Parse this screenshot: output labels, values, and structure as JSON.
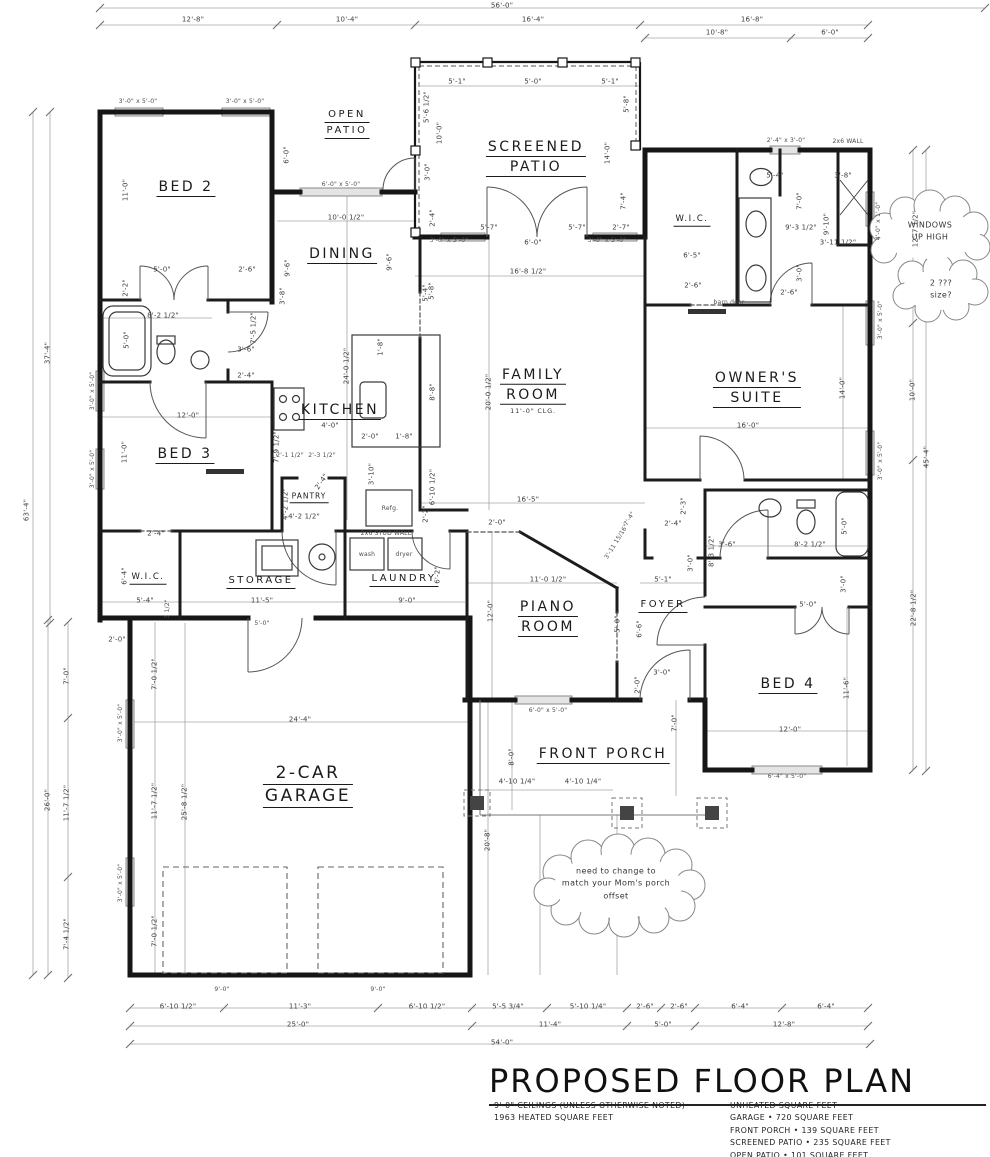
{
  "title_block": {
    "title": "PROPOSED FLOOR PLAN",
    "notes_left": [
      "9'-0\" CEILINGS (UNLESS OTHERWISE NOTED)",
      "1963 HEATED SQUARE FEET"
    ],
    "notes_right": [
      "UNHEATED SQUARE FEET",
      "GARAGE • 720 SQUARE FEET",
      "FRONT PORCH • 139 SQUARE FEET",
      "SCREENED PATIO • 235 SQUARE FEET",
      "OPEN PATIO • 101 SQUARE FEET"
    ]
  },
  "colors": {
    "wall": "#161616",
    "dim_text": "#3c3c3c",
    "dim_line": "#a6a6a6",
    "paper": "#ffffff"
  },
  "rooms": [
    {
      "id": "bed-2",
      "lines": [
        "BED 2"
      ],
      "x": 186,
      "y": 190,
      "size": "lg"
    },
    {
      "id": "open-patio",
      "lines": [
        "OPEN",
        "PATIO"
      ],
      "x": 347,
      "y": 126,
      "size": "md"
    },
    {
      "id": "screened-patio",
      "lines": [
        "SCREENED",
        "PATIO"
      ],
      "x": 536,
      "y": 160,
      "size": "lg"
    },
    {
      "id": "dining",
      "lines": [
        "DINING"
      ],
      "x": 342,
      "y": 257,
      "size": "lg"
    },
    {
      "id": "wic-owners",
      "lines": [
        "W.I.C."
      ],
      "x": 692,
      "y": 222,
      "size": "sm"
    },
    {
      "id": "owners-suite",
      "lines": [
        "OWNER'S",
        "SUITE"
      ],
      "x": 757,
      "y": 391,
      "size": "lg"
    },
    {
      "id": "kitchen",
      "lines": [
        "KITCHEN"
      ],
      "x": 340,
      "y": 413,
      "size": "lg"
    },
    {
      "id": "family-room",
      "lines": [
        "FAMILY",
        "ROOM"
      ],
      "x": 533,
      "y": 391,
      "size": "lg",
      "sub": "11'-0\" CLG."
    },
    {
      "id": "bed-3",
      "lines": [
        "BED 3"
      ],
      "x": 185,
      "y": 457,
      "size": "lg"
    },
    {
      "id": "pantry",
      "lines": [
        "PANTRY"
      ],
      "x": 309,
      "y": 499,
      "size": "xs"
    },
    {
      "id": "wic-left",
      "lines": [
        "W.I.C."
      ],
      "x": 148,
      "y": 580,
      "size": "sm"
    },
    {
      "id": "storage",
      "lines": [
        "STORAGE"
      ],
      "x": 261,
      "y": 584,
      "size": "md"
    },
    {
      "id": "laundry",
      "lines": [
        "LAUNDRY"
      ],
      "x": 404,
      "y": 582,
      "size": "md"
    },
    {
      "id": "piano-room",
      "lines": [
        "PIANO",
        "ROOM"
      ],
      "x": 548,
      "y": 620,
      "size": "lg"
    },
    {
      "id": "foyer",
      "lines": [
        "FOYER"
      ],
      "x": 663,
      "y": 608,
      "size": "md"
    },
    {
      "id": "bed-4",
      "lines": [
        "BED 4"
      ],
      "x": 788,
      "y": 687,
      "size": "lg"
    },
    {
      "id": "garage",
      "lines": [
        "2-CAR",
        "GARAGE"
      ],
      "x": 308,
      "y": 788,
      "size": "xl"
    },
    {
      "id": "front-porch",
      "lines": [
        "FRONT PORCH"
      ],
      "x": 603,
      "y": 757,
      "size": "lg"
    }
  ],
  "clouds": [
    {
      "id": "windows-up-high",
      "lines": [
        "WINDOWS",
        "UP HIGH"
      ],
      "x": 930,
      "y": 232
    },
    {
      "id": "window-size-question",
      "lines": [
        "2 ???",
        "size?"
      ],
      "x": 941,
      "y": 290
    },
    {
      "id": "porch-offset-note",
      "lines": [
        "need to change to",
        "match your Mom's porch",
        "offset"
      ],
      "x": 616,
      "y": 884
    }
  ],
  "dims": [
    {
      "t": "56'-0\"",
      "x": 502,
      "y": 6
    },
    {
      "t": "12'-8\"",
      "x": 193,
      "y": 20
    },
    {
      "t": "10'-4\"",
      "x": 347,
      "y": 20
    },
    {
      "t": "16'-4\"",
      "x": 533,
      "y": 20
    },
    {
      "t": "16'-8\"",
      "x": 752,
      "y": 20
    },
    {
      "t": "10'-8\"",
      "x": 717,
      "y": 33
    },
    {
      "t": "6'-0\"",
      "x": 830,
      "y": 33
    },
    {
      "t": "3'-0\" x 5'-0\"",
      "x": 138,
      "y": 102,
      "s": 1
    },
    {
      "t": "3'-0\" x 5'-0\"",
      "x": 245,
      "y": 102,
      "s": 1
    },
    {
      "t": "2'-4\" x 3'-0\"",
      "x": 786,
      "y": 141,
      "s": 1
    },
    {
      "t": "2x6 WALL",
      "x": 848,
      "y": 142,
      "s": 1
    },
    {
      "t": "5'-1\"",
      "x": 457,
      "y": 82
    },
    {
      "t": "5'-0\"",
      "x": 533,
      "y": 82
    },
    {
      "t": "5'-1\"",
      "x": 610,
      "y": 82
    },
    {
      "t": "5'-6 1/2\"",
      "x": 427,
      "y": 107,
      "r": -90
    },
    {
      "t": "10'-0\"",
      "x": 440,
      "y": 133,
      "r": -90
    },
    {
      "t": "3'-0\"",
      "x": 428,
      "y": 172,
      "r": -90
    },
    {
      "t": "2'-4\"",
      "x": 433,
      "y": 218,
      "r": -90
    },
    {
      "t": "5'-8\"",
      "x": 627,
      "y": 104,
      "r": -90
    },
    {
      "t": "14'-0\"",
      "x": 608,
      "y": 153,
      "r": -90
    },
    {
      "t": "7'-4\"",
      "x": 624,
      "y": 201,
      "r": -90
    },
    {
      "t": "2'-7\"",
      "x": 621,
      "y": 228
    },
    {
      "t": "5'-7\"",
      "x": 489,
      "y": 228
    },
    {
      "t": "6'-0\"",
      "x": 533,
      "y": 243
    },
    {
      "t": "5'-7\"",
      "x": 577,
      "y": 228
    },
    {
      "t": "3'-0\" x 5'-0\"",
      "x": 449,
      "y": 241,
      "s": 1
    },
    {
      "t": "3'-0\" x 5'-0\"",
      "x": 607,
      "y": 241,
      "s": 1
    },
    {
      "t": "16'-8 1/2\"",
      "x": 528,
      "y": 272
    },
    {
      "t": "5'-8\"",
      "x": 432,
      "y": 291,
      "r": -90
    },
    {
      "t": "6'-0\" x 5'-0\"",
      "x": 341,
      "y": 185,
      "s": 1
    },
    {
      "t": "10'-0 1/2\"",
      "x": 346,
      "y": 218
    },
    {
      "t": "6'-0\"",
      "x": 287,
      "y": 155,
      "r": -90
    },
    {
      "t": "9'-6\"",
      "x": 288,
      "y": 268,
      "r": -90
    },
    {
      "t": "9'-6\"",
      "x": 390,
      "y": 262,
      "r": -90
    },
    {
      "t": "11'-0\"",
      "x": 126,
      "y": 190,
      "r": -90
    },
    {
      "t": "5'-0\"",
      "x": 162,
      "y": 270
    },
    {
      "t": "2'-2\"",
      "x": 126,
      "y": 288,
      "r": -90
    },
    {
      "t": "2'-6\"",
      "x": 247,
      "y": 270
    },
    {
      "t": "8'-2 1/2\"",
      "x": 163,
      "y": 316
    },
    {
      "t": "5'-0\"",
      "x": 127,
      "y": 340,
      "r": -90
    },
    {
      "t": "7'-5 1/2\"",
      "x": 254,
      "y": 328,
      "r": -90
    },
    {
      "t": "3'-6\"",
      "x": 246,
      "y": 350
    },
    {
      "t": "2'-4\"",
      "x": 246,
      "y": 376
    },
    {
      "t": "3'-8\"",
      "x": 283,
      "y": 296,
      "r": -90
    },
    {
      "t": "24'-0 1/2\"",
      "x": 347,
      "y": 366,
      "r": -90
    },
    {
      "t": "1'-8\"",
      "x": 381,
      "y": 347,
      "r": -90
    },
    {
      "t": "12'-0\"",
      "x": 188,
      "y": 416
    },
    {
      "t": "11'-0\"",
      "x": 125,
      "y": 452,
      "r": -90
    },
    {
      "t": "4'-0\"",
      "x": 330,
      "y": 426
    },
    {
      "t": "2'-0\"",
      "x": 370,
      "y": 437
    },
    {
      "t": "1'-8\"",
      "x": 404,
      "y": 437
    },
    {
      "t": "3'-10\"",
      "x": 372,
      "y": 474,
      "r": -90
    },
    {
      "t": "2'-1 1/2\"",
      "x": 290,
      "y": 456,
      "s": 1
    },
    {
      "t": "2'-3 1/2\"",
      "x": 322,
      "y": 456,
      "s": 1
    },
    {
      "t": "7'-9 1/2\"",
      "x": 277,
      "y": 447,
      "r": -90
    },
    {
      "t": "4'-2 1/2\"",
      "x": 286,
      "y": 504,
      "r": -90
    },
    {
      "t": "4'-2 1/2\"",
      "x": 304,
      "y": 517
    },
    {
      "t": "2'-4\"",
      "x": 322,
      "y": 482,
      "r": -55
    },
    {
      "t": "Refg.",
      "x": 390,
      "y": 509,
      "s": 1
    },
    {
      "t": "2'-2\"",
      "x": 426,
      "y": 514,
      "r": -90
    },
    {
      "t": "6'-10 1/2\"",
      "x": 433,
      "y": 487,
      "r": -90
    },
    {
      "t": "2x6 STUD WALL",
      "x": 386,
      "y": 534,
      "s": 1
    },
    {
      "t": "2'-4\"",
      "x": 156,
      "y": 534
    },
    {
      "t": "6'-4\"",
      "x": 125,
      "y": 576,
      "r": -90
    },
    {
      "t": "5'-4\"",
      "x": 145,
      "y": 601
    },
    {
      "t": "3 1/2\"",
      "x": 168,
      "y": 609,
      "r": -90,
      "s": 1
    },
    {
      "t": "11'-5\"",
      "x": 262,
      "y": 601
    },
    {
      "t": "9'-0\"",
      "x": 407,
      "y": 601
    },
    {
      "t": "wash",
      "x": 367,
      "y": 555,
      "s": 1
    },
    {
      "t": "dryer",
      "x": 404,
      "y": 555,
      "s": 1
    },
    {
      "t": "6'-2\"",
      "x": 438,
      "y": 575,
      "r": -90
    },
    {
      "t": "20'-0 1/2\"",
      "x": 489,
      "y": 392,
      "r": -90
    },
    {
      "t": "8'-8\"",
      "x": 433,
      "y": 392,
      "r": -90
    },
    {
      "t": "5'-4\"",
      "x": 426,
      "y": 293,
      "r": -90
    },
    {
      "t": "16'-5\"",
      "x": 528,
      "y": 500
    },
    {
      "t": "2'-0\"",
      "x": 497,
      "y": 523
    },
    {
      "t": "3'-11 15/16\"",
      "x": 617,
      "y": 542,
      "r": -58,
      "s": 1
    },
    {
      "t": "7'-4\"",
      "x": 630,
      "y": 519,
      "r": -58,
      "s": 1
    },
    {
      "t": "11'-0 1/2\"",
      "x": 548,
      "y": 580
    },
    {
      "t": "12'-0\"",
      "x": 491,
      "y": 611,
      "r": -90
    },
    {
      "t": "5'-0\"",
      "x": 618,
      "y": 624,
      "r": -90
    },
    {
      "t": "6'-6\"",
      "x": 640,
      "y": 629,
      "r": -90
    },
    {
      "t": "5'-1\"",
      "x": 663,
      "y": 580
    },
    {
      "t": "3'-0\"",
      "x": 691,
      "y": 563,
      "r": -90
    },
    {
      "t": "3'-0\"",
      "x": 662,
      "y": 673
    },
    {
      "t": "2'-0\"",
      "x": 638,
      "y": 685,
      "r": -90
    },
    {
      "t": "7'-0\"",
      "x": 675,
      "y": 723,
      "r": -90
    },
    {
      "t": "6'-0\" x 5'-0\"",
      "x": 548,
      "y": 711,
      "s": 1
    },
    {
      "t": "5'-4\"",
      "x": 775,
      "y": 176
    },
    {
      "t": "3'-8\"",
      "x": 843,
      "y": 176
    },
    {
      "t": "7'-0\"",
      "x": 800,
      "y": 201,
      "r": -90
    },
    {
      "t": "9'-10\"",
      "x": 827,
      "y": 224,
      "r": -90
    },
    {
      "t": "9'-3 1/2\"",
      "x": 801,
      "y": 228
    },
    {
      "t": "3'-11 1/2\"",
      "x": 838,
      "y": 243
    },
    {
      "t": "6'-5\"",
      "x": 692,
      "y": 256
    },
    {
      "t": "3'-0\"",
      "x": 800,
      "y": 273,
      "r": -90
    },
    {
      "t": "2'-6\"",
      "x": 693,
      "y": 286
    },
    {
      "t": "2'-6\"",
      "x": 789,
      "y": 293
    },
    {
      "t": "barn door",
      "x": 729,
      "y": 303,
      "s": 1
    },
    {
      "t": "12'-7 1/2\"",
      "x": 916,
      "y": 229,
      "r": -90
    },
    {
      "t": "4'-0\" x 1'-0\"",
      "x": 879,
      "y": 221,
      "r": -90,
      "s": 1
    },
    {
      "t": "16'-0\"",
      "x": 748,
      "y": 426
    },
    {
      "t": "14'-0\"",
      "x": 843,
      "y": 388,
      "r": -90
    },
    {
      "t": "3'-0\" x 5'-0\"",
      "x": 881,
      "y": 320,
      "r": -90,
      "s": 1
    },
    {
      "t": "3'-0\" x 5'-0\"",
      "x": 881,
      "y": 461,
      "r": -90,
      "s": 1
    },
    {
      "t": "10'-0\"",
      "x": 913,
      "y": 390,
      "r": -90
    },
    {
      "t": "45'-4\"",
      "x": 927,
      "y": 457,
      "r": -90
    },
    {
      "t": "22'-8 1/2\"",
      "x": 914,
      "y": 608,
      "r": -90
    },
    {
      "t": "2'-3\"",
      "x": 684,
      "y": 506,
      "r": -90
    },
    {
      "t": "2'-4\"",
      "x": 673,
      "y": 524
    },
    {
      "t": "3'-6\"",
      "x": 727,
      "y": 545
    },
    {
      "t": "8'-3 1/2\"",
      "x": 712,
      "y": 551,
      "r": -90
    },
    {
      "t": "8'-2 1/2\"",
      "x": 810,
      "y": 545
    },
    {
      "t": "5'-0\"",
      "x": 845,
      "y": 526,
      "r": -90
    },
    {
      "t": "3'-0\"",
      "x": 844,
      "y": 584,
      "r": -90
    },
    {
      "t": "5'-0\"",
      "x": 808,
      "y": 605
    },
    {
      "t": "11'-6\"",
      "x": 847,
      "y": 688,
      "r": -90
    },
    {
      "t": "12'-0\"",
      "x": 790,
      "y": 730
    },
    {
      "t": "6'-4\" x 5'-0\"",
      "x": 787,
      "y": 777,
      "s": 1
    },
    {
      "t": "2'-0\"",
      "x": 117,
      "y": 640
    },
    {
      "t": "7'-0 1/2\"",
      "x": 155,
      "y": 674,
      "r": -90
    },
    {
      "t": "24'-4\"",
      "x": 300,
      "y": 720
    },
    {
      "t": "11'-7 1/2\"",
      "x": 155,
      "y": 801,
      "r": -90
    },
    {
      "t": "25'-8 1/2\"",
      "x": 185,
      "y": 802,
      "r": -90
    },
    {
      "t": "20'-8\"",
      "x": 488,
      "y": 840,
      "r": -90
    },
    {
      "t": "7'-0 1/2\"",
      "x": 155,
      "y": 931,
      "r": -90
    },
    {
      "t": "3'-0\" x 5'-0\"",
      "x": 121,
      "y": 723,
      "r": -90,
      "s": 1
    },
    {
      "t": "3'-0\" x 5'-0\"",
      "x": 121,
      "y": 883,
      "r": -90,
      "s": 1
    },
    {
      "t": "5'-0\"",
      "x": 262,
      "y": 624,
      "s": 1
    },
    {
      "t": "8'-0\"",
      "x": 512,
      "y": 757,
      "r": -90
    },
    {
      "t": "4'-10 1/4\"",
      "x": 517,
      "y": 782
    },
    {
      "t": "4'-10 1/4\"",
      "x": 583,
      "y": 782
    },
    {
      "t": "9'-0\"",
      "x": 222,
      "y": 990,
      "s": 1
    },
    {
      "t": "9'-0\"",
      "x": 378,
      "y": 990,
      "s": 1
    },
    {
      "t": "6'-10 1/2\"",
      "x": 178,
      "y": 1007
    },
    {
      "t": "11'-3\"",
      "x": 300,
      "y": 1007
    },
    {
      "t": "6'-10 1/2\"",
      "x": 427,
      "y": 1007
    },
    {
      "t": "5'-5 3/4\"",
      "x": 508,
      "y": 1007
    },
    {
      "t": "5'-10 1/4\"",
      "x": 588,
      "y": 1007
    },
    {
      "t": "2'-6\"",
      "x": 645,
      "y": 1007
    },
    {
      "t": "2'-6\"",
      "x": 679,
      "y": 1007
    },
    {
      "t": "6'-4\"",
      "x": 740,
      "y": 1007
    },
    {
      "t": "6'-4\"",
      "x": 826,
      "y": 1007
    },
    {
      "t": "25'-0\"",
      "x": 298,
      "y": 1025
    },
    {
      "t": "11'-4\"",
      "x": 550,
      "y": 1025
    },
    {
      "t": "5'-0\"",
      "x": 663,
      "y": 1025
    },
    {
      "t": "12'-8\"",
      "x": 784,
      "y": 1025
    },
    {
      "t": "54'-0\"",
      "x": 502,
      "y": 1043
    },
    {
      "t": "63'-4\"",
      "x": 27,
      "y": 510,
      "r": -90
    },
    {
      "t": "37'-4\"",
      "x": 48,
      "y": 353,
      "r": -90
    },
    {
      "t": "26'-0\"",
      "x": 48,
      "y": 800,
      "r": -90
    },
    {
      "t": "7'-0\"",
      "x": 67,
      "y": 676,
      "r": -90
    },
    {
      "t": "11'-7 1/2\"",
      "x": 67,
      "y": 803,
      "r": -90
    },
    {
      "t": "7'-4 1/2\"",
      "x": 67,
      "y": 934,
      "r": -90
    },
    {
      "t": "3'-0\" x 5'-0\"",
      "x": 93,
      "y": 391,
      "r": -90,
      "s": 1
    },
    {
      "t": "3'-0\" x 5'-0\"",
      "x": 93,
      "y": 469,
      "r": -90,
      "s": 1
    }
  ]
}
